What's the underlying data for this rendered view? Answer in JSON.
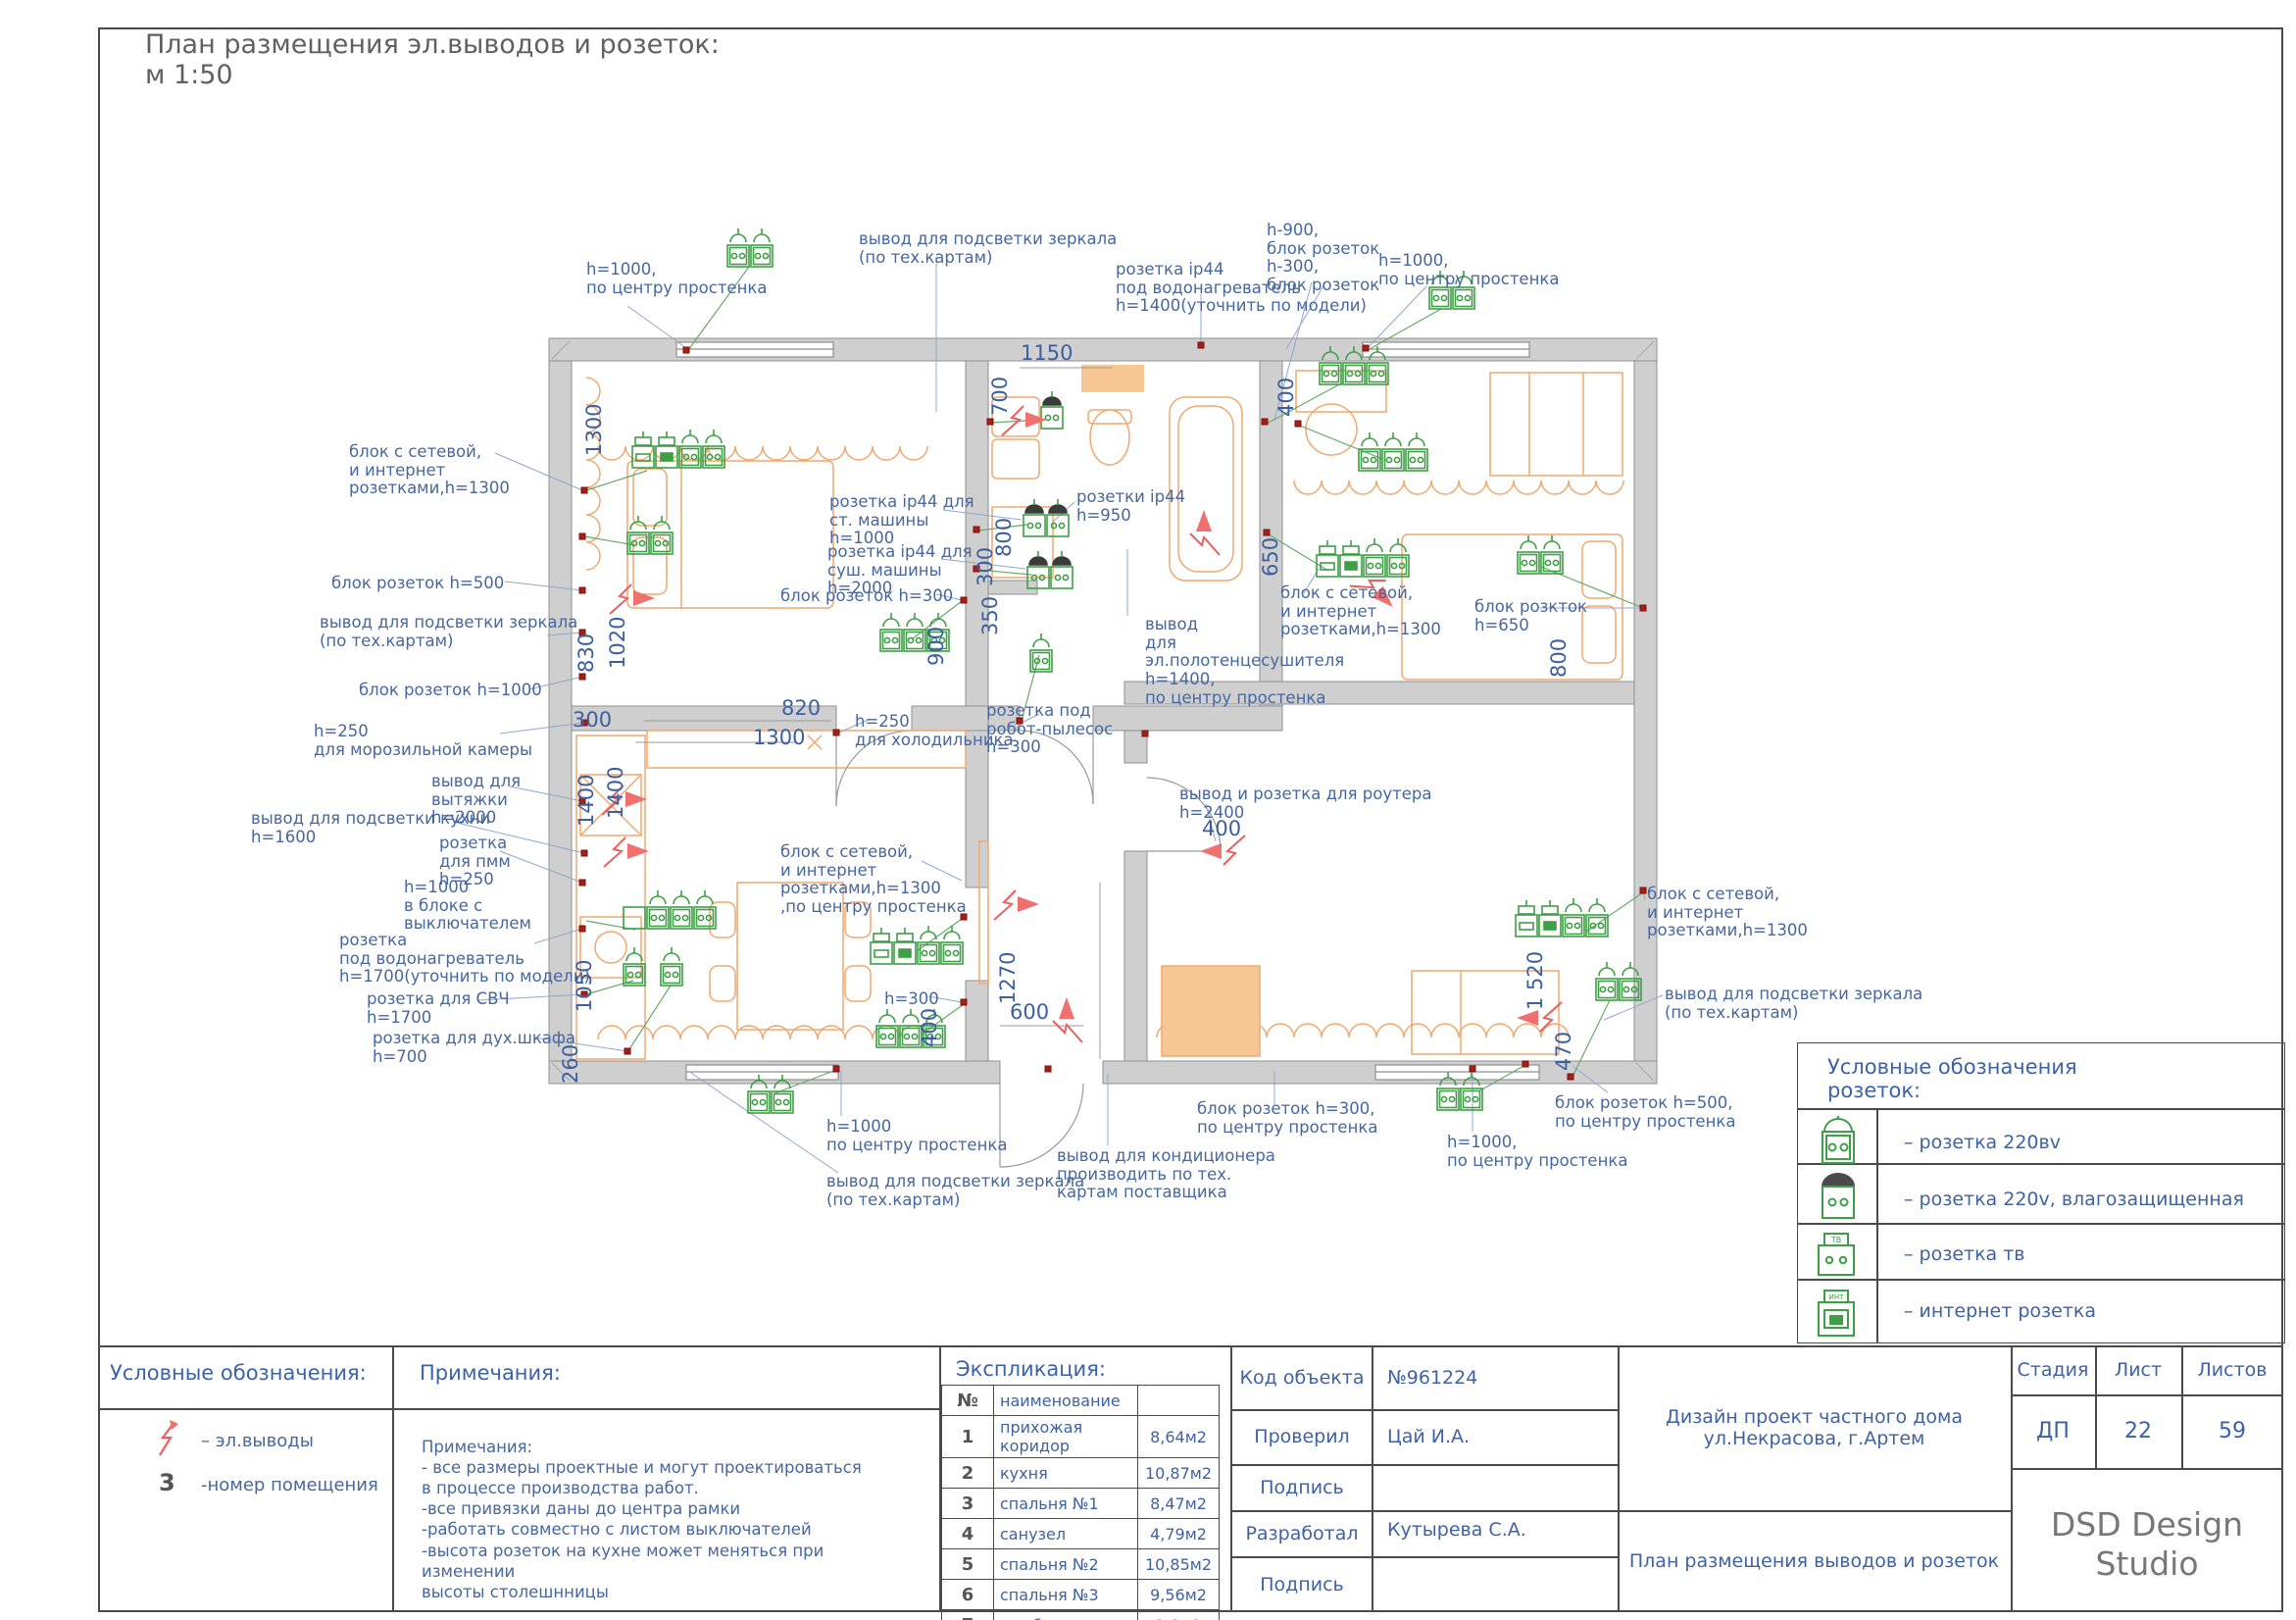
{
  "title": {
    "line1": "План размещения эл.выводов и розеток:",
    "line2": " м 1:50"
  },
  "plan": {
    "labels": [
      {
        "text": "h=1000,\nпо центру простенка"
      },
      {
        "text": "блок с сетевой,\n и интернет\nрозетками,h=1300"
      },
      {
        "text": "блок розеток h=500"
      },
      {
        "text": "вывод для подсветки зеркала\n(по тех.картам)"
      },
      {
        "text": "блок розеток h=1000"
      },
      {
        "text": "h=250\nдля морозильной камеры"
      },
      {
        "text": "вывод для\nвытяжки\nh=2000"
      },
      {
        "text": "вывод для подсветки кухни\n h=1600"
      },
      {
        "text": "розетка\nдля пмм\nh=250"
      },
      {
        "text": "h=1000\nв блоке с\nвыключателем"
      },
      {
        "text": "розетка\nпод водонагреватель\nh=1700(уточнить по модели)"
      },
      {
        "text": "розетка для СВЧ\nh=1700"
      },
      {
        "text": "розетка для дух.шкафа\nh=700"
      },
      {
        "text": "вывод для подсветки зеркала\n(по тех.картам)"
      },
      {
        "text": "розетка ip44\nпод водонагреватель\nh=1400(уточнить по модели)"
      },
      {
        "text": "h-900,\nблок розеток\nh-300,\n блок розеток"
      },
      {
        "text": "h=1000,\nпо центру простенка"
      },
      {
        "text": "розетка ip44 для\nст. машины\nh=1000"
      },
      {
        "text": "розетка ip44 для\nсуш. машины\nh=2000"
      },
      {
        "text": "блок розеток h=300"
      },
      {
        "text": "розетки ip44\nh=950"
      },
      {
        "text": "вывод\n для\nэл.полотенцесушителя\nh=1400,\nпо центру простенка"
      },
      {
        "text": "блок с сетевой,\n и интернет\nрозетками,h=1300"
      },
      {
        "text": "блок розкток\nh=650"
      },
      {
        "text": "розетка под\nробот-пылесос\nh=300"
      },
      {
        "text": "h=250\nдля холодильника"
      },
      {
        "text": "блок с сетевой,\n и интернет\nрозетками,h=1300\n,по центру простенка"
      },
      {
        "text": "h=300"
      },
      {
        "text": "вывод и розетка для роутера\nh=2400"
      },
      {
        "text": "блок с сетевой,\n и интернет\nрозетками,h=1300"
      },
      {
        "text": "вывод для подсветки зеркала\n(по тех.картам)"
      },
      {
        "text": "h=1000\nпо центру простенка"
      },
      {
        "text": "вывод для подсветки зеркала\n(по тех.картам)"
      },
      {
        "text": "вывод для кондиционера\nпроизводить по тех.\nкартам поставщика"
      },
      {
        "text": "блок розеток h=300,\nпо центру простенка"
      },
      {
        "text": "h=1000,\nпо центру простенка"
      },
      {
        "text": "блок розеток h=500,\nпо центру простенка"
      }
    ],
    "dims": [
      "1300",
      "830",
      "1020",
      "300",
      "1400",
      "1400",
      "1050",
      "260",
      "820",
      "1300",
      "900",
      "350",
      "300",
      "800",
      "700",
      "1150",
      "650",
      "800",
      "400",
      "400",
      "1270",
      "600",
      "400",
      "1 520",
      "470"
    ]
  },
  "legend": {
    "title": "Условные обозначения\nрозеток:",
    "items": [
      {
        "icon": "socket-220v-icon",
        "label": "– розетка 220вv"
      },
      {
        "icon": "socket-220v-waterproof-icon",
        "label": "– розетка 220v, влагозащищенная"
      },
      {
        "icon": "socket-tv-icon",
        "icon_label": "ТВ",
        "label": "– розетка тв"
      },
      {
        "icon": "socket-internet-icon",
        "icon_label": "ИНТ",
        "label": "– интернет розетка"
      }
    ]
  },
  "footer": {
    "symbols": {
      "title": "Условные обозначения:",
      "items": [
        {
          "icon": "electrical-output-icon",
          "label": "– эл.выводы"
        },
        {
          "num": "3",
          "label": "-номер помещения"
        }
      ]
    },
    "notes": {
      "title": "Примечания:",
      "body": "Примечания:\n- все размеры проектные и могут проектироваться\n в процессе производства работ.\n -все привязки даны до центра рамки\n-работать совместно с листом выключателей\n-высота розеток на кухне может меняться при изменении\nвысоты столешнницы"
    },
    "explication": {
      "title": "Экспликация:",
      "col_num": "№",
      "col_name": "наименование",
      "col_area": "",
      "rows": [
        [
          "1",
          "прихожая коридор",
          "8,64м2"
        ],
        [
          "2",
          "кухня",
          "10,87м2"
        ],
        [
          "3",
          "спальня №1",
          "8,47м2"
        ],
        [
          "4",
          "санузел",
          "4,79м2"
        ],
        [
          "5",
          "спальня №2",
          "10,85м2"
        ],
        [
          "6",
          "спальня №3",
          "9,56м2"
        ],
        [
          "7",
          "коз.блок",
          "1,8м2"
        ]
      ]
    },
    "titleblock": {
      "object_code_label": "Код объекта",
      "object_code": "№961224",
      "checked_label": "Проверил",
      "checked": "Цай И.А.",
      "sign1_label": "Подпись",
      "developed_label": "Разработал",
      "developed": "Кутырева С.А.",
      "sign2_label": "Подпись",
      "project": "Дизайн проект частного дома\nул.Некрасова, г.Артем",
      "sheet_title": "План размещения выводов и розеток",
      "stage_label": "Стадия",
      "sheet_label": "Лист",
      "sheets_label": "Листов",
      "stage": "ДП",
      "sheet": "22",
      "sheets": "59",
      "studio": "DSD Design\nStudio"
    }
  }
}
